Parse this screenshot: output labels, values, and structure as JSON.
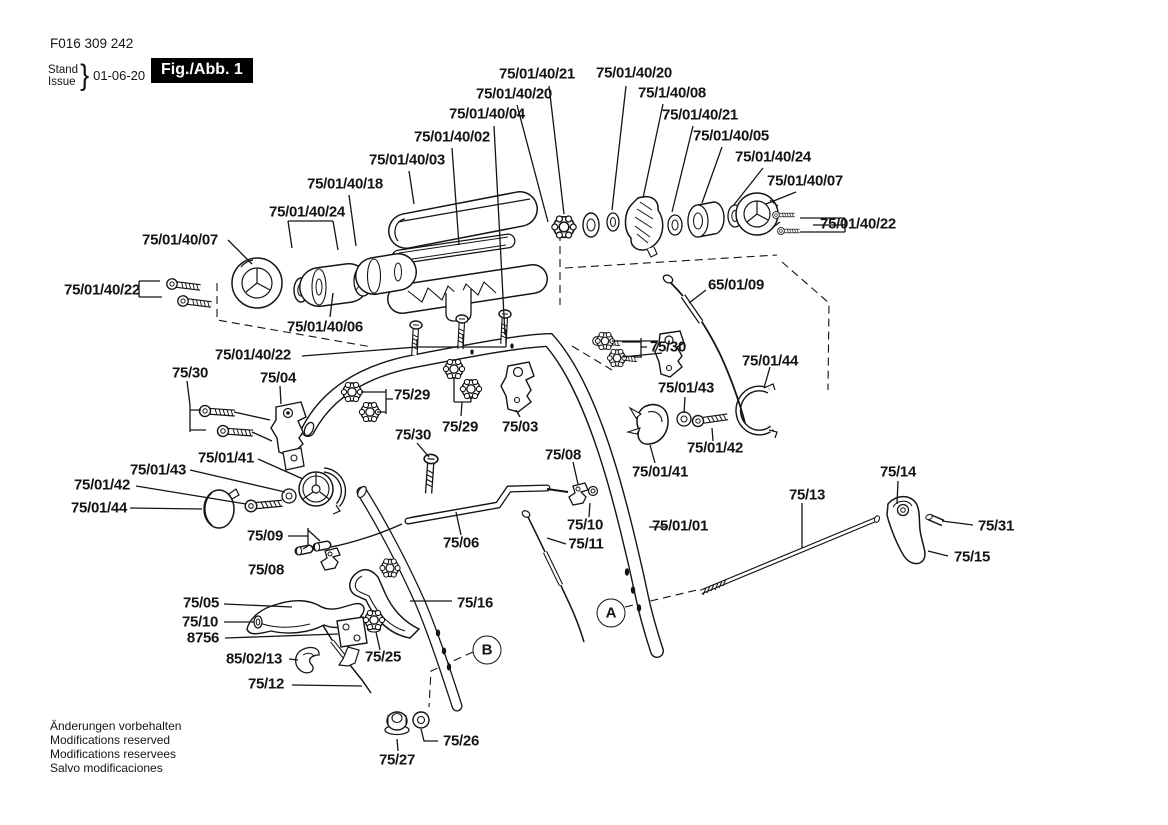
{
  "header": {
    "part_number": "F016 309 242",
    "stand_label": "Stand",
    "issue_label": "Issue",
    "brace": "}",
    "date": "01-06-20",
    "figure_label": "Fig./Abb. 1"
  },
  "footer": {
    "lines": [
      "Änderungen vorbehalten",
      "Modifications reserved",
      "Modifications reservees",
      "Salvo modificaciones"
    ]
  },
  "markers": [
    {
      "id": "A",
      "x": 611,
      "y": 613
    },
    {
      "id": "B",
      "x": 487,
      "y": 650
    }
  ],
  "labels": [
    {
      "text": "75/01/40/21",
      "x": 537,
      "y": 74
    },
    {
      "text": "75/01/40/20",
      "x": 634,
      "y": 73
    },
    {
      "text": "75/01/40/20",
      "x": 514,
      "y": 94
    },
    {
      "text": "75/1/40/08",
      "x": 672,
      "y": 93
    },
    {
      "text": "75/01/40/04",
      "x": 487,
      "y": 114
    },
    {
      "text": "75/01/40/21",
      "x": 700,
      "y": 115
    },
    {
      "text": "75/01/40/02",
      "x": 452,
      "y": 137
    },
    {
      "text": "75/01/40/05",
      "x": 731,
      "y": 136
    },
    {
      "text": "75/01/40/03",
      "x": 407,
      "y": 160
    },
    {
      "text": "75/01/40/24",
      "x": 773,
      "y": 157
    },
    {
      "text": "75/01/40/18",
      "x": 345,
      "y": 184
    },
    {
      "text": "75/01/40/07",
      "x": 805,
      "y": 181
    },
    {
      "text": "75/01/40/24",
      "x": 307,
      "y": 212
    },
    {
      "text": "75/01/40/22",
      "x": 858,
      "y": 224
    },
    {
      "text": "75/01/40/07",
      "x": 180,
      "y": 240
    },
    {
      "text": "75/01/40/22",
      "x": 102,
      "y": 290
    },
    {
      "text": "65/01/09",
      "x": 736,
      "y": 285
    },
    {
      "text": "75/01/40/06",
      "x": 325,
      "y": 327
    },
    {
      "text": "75/30",
      "x": 668,
      "y": 347
    },
    {
      "text": "75/01/40/22",
      "x": 253,
      "y": 355
    },
    {
      "text": "75/01/44",
      "x": 770,
      "y": 361
    },
    {
      "text": "75/30",
      "x": 190,
      "y": 373
    },
    {
      "text": "75/04",
      "x": 278,
      "y": 378
    },
    {
      "text": "75/01/43",
      "x": 686,
      "y": 388
    },
    {
      "text": "75/29",
      "x": 412,
      "y": 395
    },
    {
      "text": "75/29",
      "x": 460,
      "y": 427
    },
    {
      "text": "75/03",
      "x": 520,
      "y": 427
    },
    {
      "text": "75/30",
      "x": 413,
      "y": 435
    },
    {
      "text": "75/01/42",
      "x": 715,
      "y": 448
    },
    {
      "text": "75/01/41",
      "x": 226,
      "y": 458
    },
    {
      "text": "75/08",
      "x": 563,
      "y": 455
    },
    {
      "text": "75/01/43",
      "x": 158,
      "y": 470
    },
    {
      "text": "75/01/41",
      "x": 660,
      "y": 472
    },
    {
      "text": "75/14",
      "x": 898,
      "y": 472
    },
    {
      "text": "75/01/42",
      "x": 102,
      "y": 485
    },
    {
      "text": "75/13",
      "x": 807,
      "y": 495
    },
    {
      "text": "75/01/44",
      "x": 99,
      "y": 508
    },
    {
      "text": "75/10",
      "x": 585,
      "y": 525
    },
    {
      "text": "75/01/01",
      "x": 680,
      "y": 526
    },
    {
      "text": "75/31",
      "x": 996,
      "y": 526
    },
    {
      "text": "75/09",
      "x": 265,
      "y": 536
    },
    {
      "text": "75/06",
      "x": 461,
      "y": 543
    },
    {
      "text": "75/11",
      "x": 586,
      "y": 544
    },
    {
      "text": "75/15",
      "x": 972,
      "y": 557
    },
    {
      "text": "75/08",
      "x": 266,
      "y": 570
    },
    {
      "text": "75/16",
      "x": 475,
      "y": 603
    },
    {
      "text": "75/05",
      "x": 201,
      "y": 603
    },
    {
      "text": "75/10",
      "x": 200,
      "y": 622
    },
    {
      "text": "8756",
      "x": 203,
      "y": 638
    },
    {
      "text": "85/02/13",
      "x": 254,
      "y": 659
    },
    {
      "text": "75/25",
      "x": 383,
      "y": 657
    },
    {
      "text": "75/12",
      "x": 266,
      "y": 684
    },
    {
      "text": "75/26",
      "x": 461,
      "y": 741
    },
    {
      "text": "75/27",
      "x": 397,
      "y": 760
    }
  ]
}
